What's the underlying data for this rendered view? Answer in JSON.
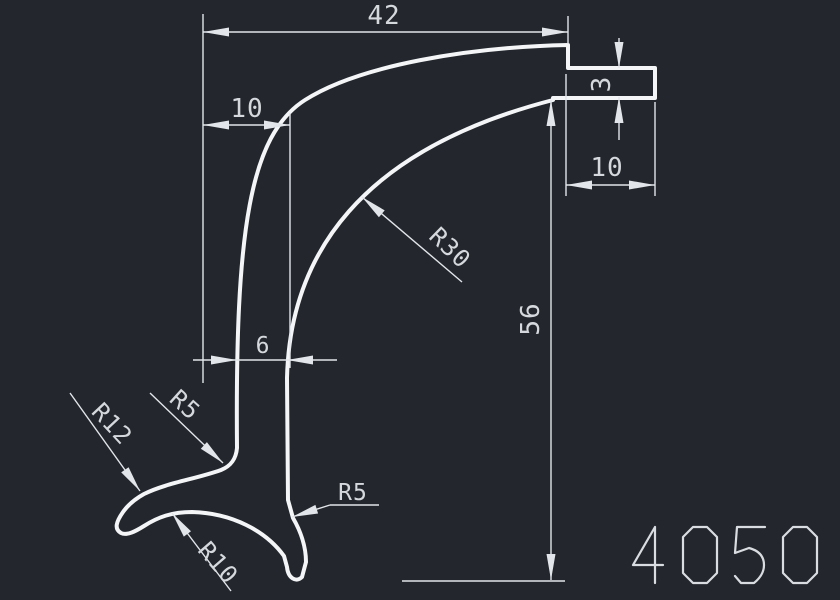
{
  "title": "profile-cross-section-drawing",
  "part_number": "4050",
  "colors": {
    "background": "#23272d",
    "profile": "#f3f5f7",
    "dimension": "#e2e6ea",
    "text": "#d5d9dd",
    "part_number_stroke": "#d9dde1"
  },
  "dimensions": {
    "top_width": "42",
    "upper_left_offset": "10",
    "tab_thickness": "3",
    "tab_length": "10",
    "overall_height": "56",
    "wall_thickness": "6"
  },
  "radius_labels": {
    "arch_inner": "R30",
    "stem_left_fillet": "R5",
    "foot_top": "R12",
    "foot_bottom": "R10",
    "stem_right_fillet": "R5"
  }
}
